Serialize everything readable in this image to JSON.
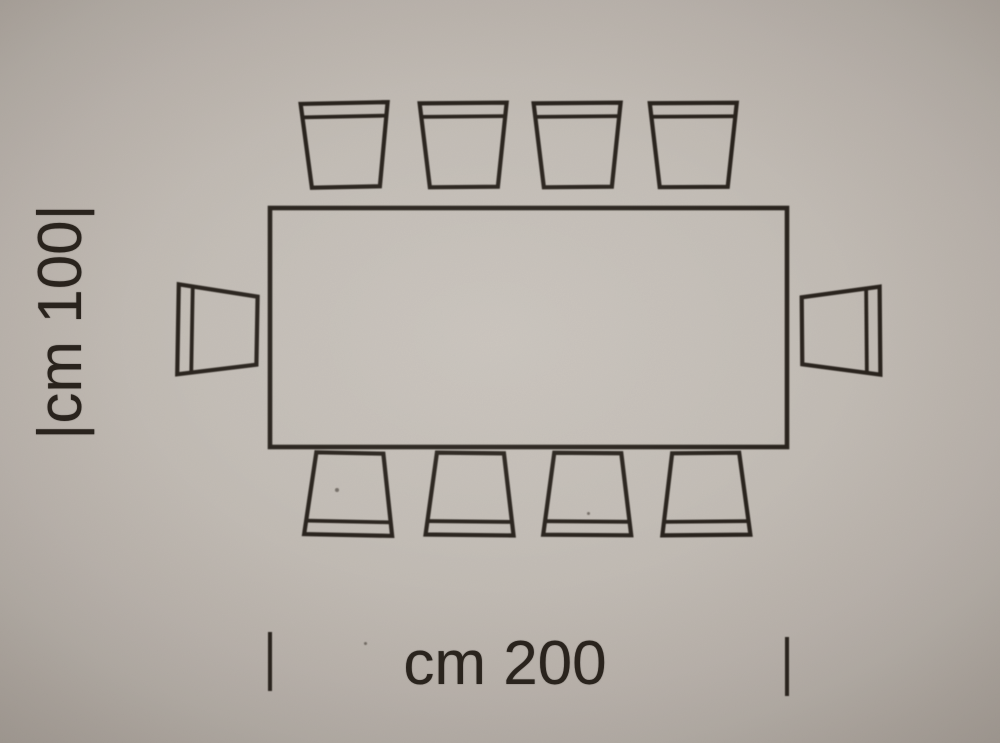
{
  "diagram": {
    "kind": "table-with-chairs top view dimension drawing",
    "depth_label": "|cm 100|",
    "width_label": "cm 200",
    "table": {
      "shape": "rectangle",
      "width_cm": 200,
      "depth_cm": 100
    },
    "chairs": {
      "top": 4,
      "bottom": 4,
      "left": 1,
      "right": 1,
      "total": 10
    },
    "colors": {
      "ink": "#29231d",
      "paper": "#c2bbb4"
    }
  }
}
